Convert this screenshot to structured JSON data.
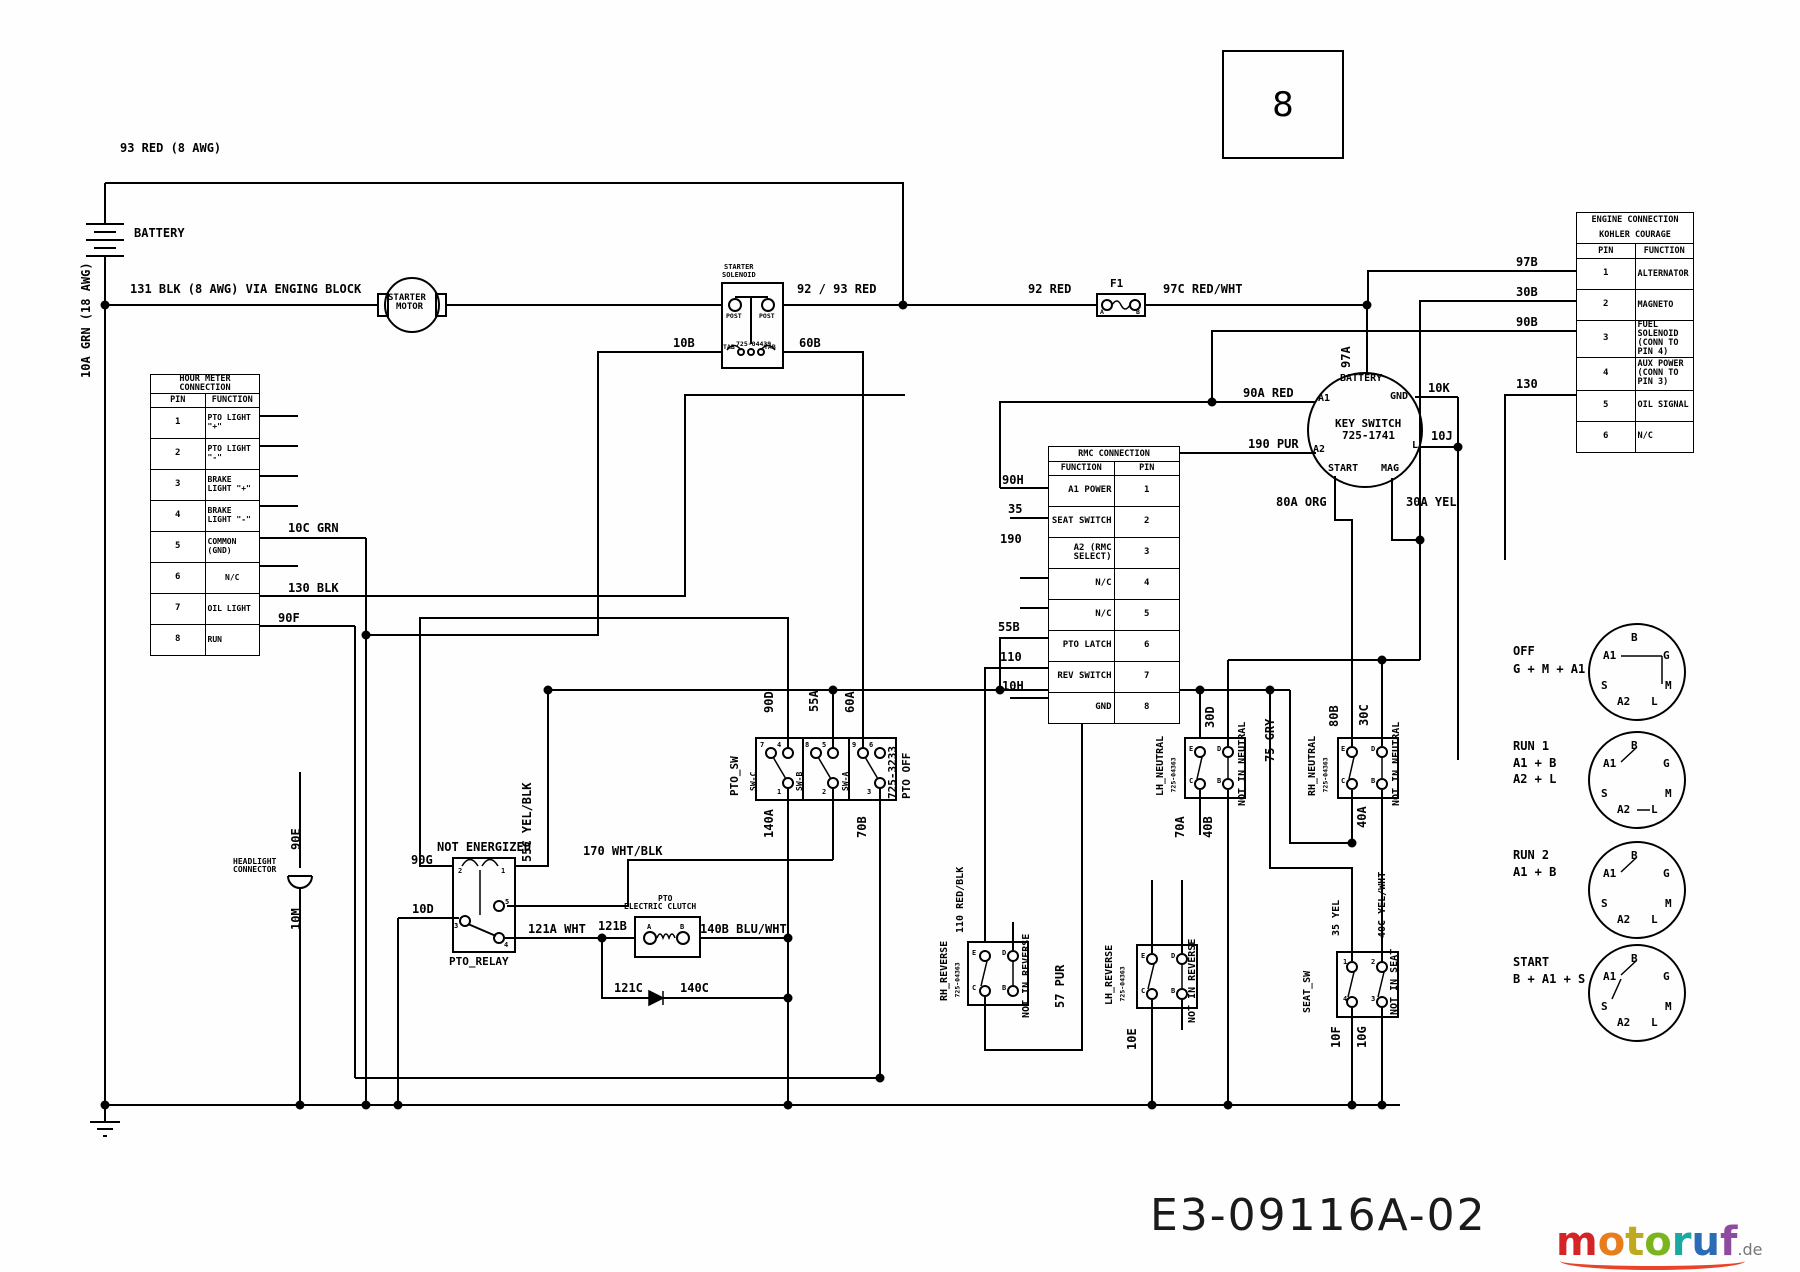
{
  "page": {
    "number": "8",
    "doc_number": "E3-09116A-02"
  },
  "brand": {
    "letters": [
      "m",
      "o",
      "t",
      "o",
      "r",
      "u",
      "f"
    ],
    "tld": ".de",
    "letter_colors": [
      "#d42428",
      "#e87d1e",
      "#bfa91c",
      "#7ab51d",
      "#1ba8a0",
      "#2b6cb8",
      "#8d4a9e"
    ],
    "swoosh_color": "#e8442a"
  },
  "labels": {
    "w93": "93 RED (8 AWG)",
    "battery": "BATTERY",
    "w10a": "10A GRN (18 AWG)",
    "w131": "131 BLK (8 AWG) VIA ENGING BLOCK",
    "starter_l1": "STARTER",
    "starter_l2": "MOTOR",
    "sol_l2": "SOLENOID",
    "post": "POST",
    "tab": "TAB",
    "sol_pn": "725-04439",
    "w10b": "10B",
    "w60b": "60B",
    "w9293": "92 / 93 RED",
    "w92": "92 RED",
    "f1": "F1",
    "term_a": "A",
    "term_b": "B",
    "term_c": "C",
    "term_d": "D",
    "term_e": "E",
    "w97c": "97C RED/WHT",
    "w97a": "97A",
    "w97b": "97B",
    "w30b": "30B",
    "w90b": "90B",
    "w130": "130",
    "ks_battery": "BATTERY",
    "ks_a1": "A1",
    "ks_a2": "A2",
    "ks_gnd": "GND",
    "ks_l": "L",
    "ks_start": "START",
    "ks_mag": "MAG",
    "ks_name": "KEY SWITCH",
    "ks_pn": "725-1741",
    "w90a": "90A RED",
    "w190pur": "190 PUR",
    "w10k": "10K",
    "w10j": "10J",
    "w80a": "80A ORG",
    "w30a": "30A YEL",
    "w10cgrn": "10C GRN",
    "w130blk": "130 BLK",
    "w90f": "90F",
    "w90h": "90H",
    "w35": "35",
    "w190": "190",
    "w55b": "55B",
    "w110": "110",
    "w10h": "10H",
    "pto_sw": "PTO_SW",
    "sw_c": "SW-C",
    "sw_b": "SW-B",
    "sw_a": "SW-A",
    "pto_pn": "725-3233",
    "pto_off": "PTO OFF",
    "n1": "1",
    "n2": "2",
    "n3": "3",
    "n4": "4",
    "n5": "5",
    "n6": "6",
    "n7": "7",
    "n8": "8",
    "n9": "9",
    "w90d": "90D",
    "w55a": "55A",
    "w60a": "60A",
    "w140a": "140A",
    "w70b": "70B",
    "w55c": "55C YEL/BLK",
    "w170": "170 WHT/BLK",
    "not_energized": "NOT ENERGIZED",
    "pto_relay": "PTO_RELAY",
    "w90g": "90G",
    "w10d": "10D",
    "w121a": "121A WHT",
    "w121b": "121B",
    "clutch_l1": "PTO",
    "clutch_l2": "ELECTRIC CLUTCH",
    "w140b": "140B BLU/WHT",
    "w121c": "121C",
    "w140c": "140C",
    "hl_l1": "HEADLIGHT",
    "hl_l2": "CONNECTOR",
    "w90e": "90E",
    "w10m": "10M",
    "lh_neutral": "LH_NEUTRAL",
    "rh_neutral": "RH_NEUTRAL",
    "sw_pn": "725-04363",
    "w30d": "30D",
    "not_in_neutral": "NOT IN NEUTRAL",
    "w70a": "70A",
    "w40b": "40B",
    "w75gry": "75 GRY",
    "w80b": "80B",
    "w30c": "30C",
    "w40a": "40A",
    "rh_reverse": "RH_REVERSE",
    "lh_reverse": "LH_REVERSE",
    "w110rb": "110 RED/BLK",
    "not_in_reverse": "NOT IN REVERSE",
    "w57pur": "57 PUR",
    "w10e": "10E",
    "seat_sw": "SEAT_SW",
    "not_in_seat": "NOT IN SEAT",
    "w35yel": "35 YEL",
    "w40c": "40C YEL/WHT",
    "w10f": "10F",
    "w10g": "10G"
  },
  "tables": {
    "hour_meter": {
      "title": "HOUR METER CONNECTION",
      "col_pin": "PIN",
      "col_function": "FUNCTION",
      "rows": [
        {
          "pin": "1",
          "function": "PTO LIGHT \"+\""
        },
        {
          "pin": "2",
          "function": "PTO LIGHT \"-\""
        },
        {
          "pin": "3",
          "function": "BRAKE LIGHT \"+\""
        },
        {
          "pin": "4",
          "function": "BRAKE LIGHT \"-\""
        },
        {
          "pin": "5",
          "function": "COMMON (GND)"
        },
        {
          "pin": "6",
          "function": "N/C"
        },
        {
          "pin": "7",
          "function": "OIL LIGHT"
        },
        {
          "pin": "8",
          "function": "RUN"
        }
      ]
    },
    "rmc": {
      "title": "RMC CONNECTION",
      "col_function": "FUNCTION",
      "col_pin": "PIN",
      "rows": [
        {
          "function": "A1 POWER",
          "pin": "1"
        },
        {
          "function": "SEAT SWITCH",
          "pin": "2"
        },
        {
          "function": "A2 (RMC SELECT)",
          "pin": "3"
        },
        {
          "function": "N/C",
          "pin": "4"
        },
        {
          "function": "N/C",
          "pin": "5"
        },
        {
          "function": "PTO LATCH",
          "pin": "6"
        },
        {
          "function": "REV SWITCH",
          "pin": "7"
        },
        {
          "function": "GND",
          "pin": "8"
        }
      ]
    },
    "engine": {
      "title": "ENGINE CONNECTION",
      "subtitle": "KOHLER COURAGE",
      "col_pin": "PIN",
      "col_function": "FUNCTION",
      "rows": [
        {
          "pin": "1",
          "function": "ALTERNATOR"
        },
        {
          "pin": "2",
          "function": "MAGNETO"
        },
        {
          "pin": "3",
          "function": "FUEL SOLENOID (CONN TO PIN 4)"
        },
        {
          "pin": "4",
          "function": "AUX POWER (CONN TO PIN 3)"
        },
        {
          "pin": "5",
          "function": "OIL SIGNAL"
        },
        {
          "pin": "6",
          "function": "N/C"
        }
      ]
    }
  },
  "key_positions": [
    {
      "name": "OFF",
      "lines": [
        "G + M + A1"
      ]
    },
    {
      "name": "RUN 1",
      "lines": [
        "A1 + B",
        "A2 + L"
      ]
    },
    {
      "name": "RUN 2",
      "lines": [
        "A1 + B"
      ]
    },
    {
      "name": "START",
      "lines": [
        "B + A1 + S"
      ]
    }
  ],
  "terminal_letters": [
    "B",
    "A1",
    "G",
    "S",
    "M",
    "A2",
    "L"
  ]
}
